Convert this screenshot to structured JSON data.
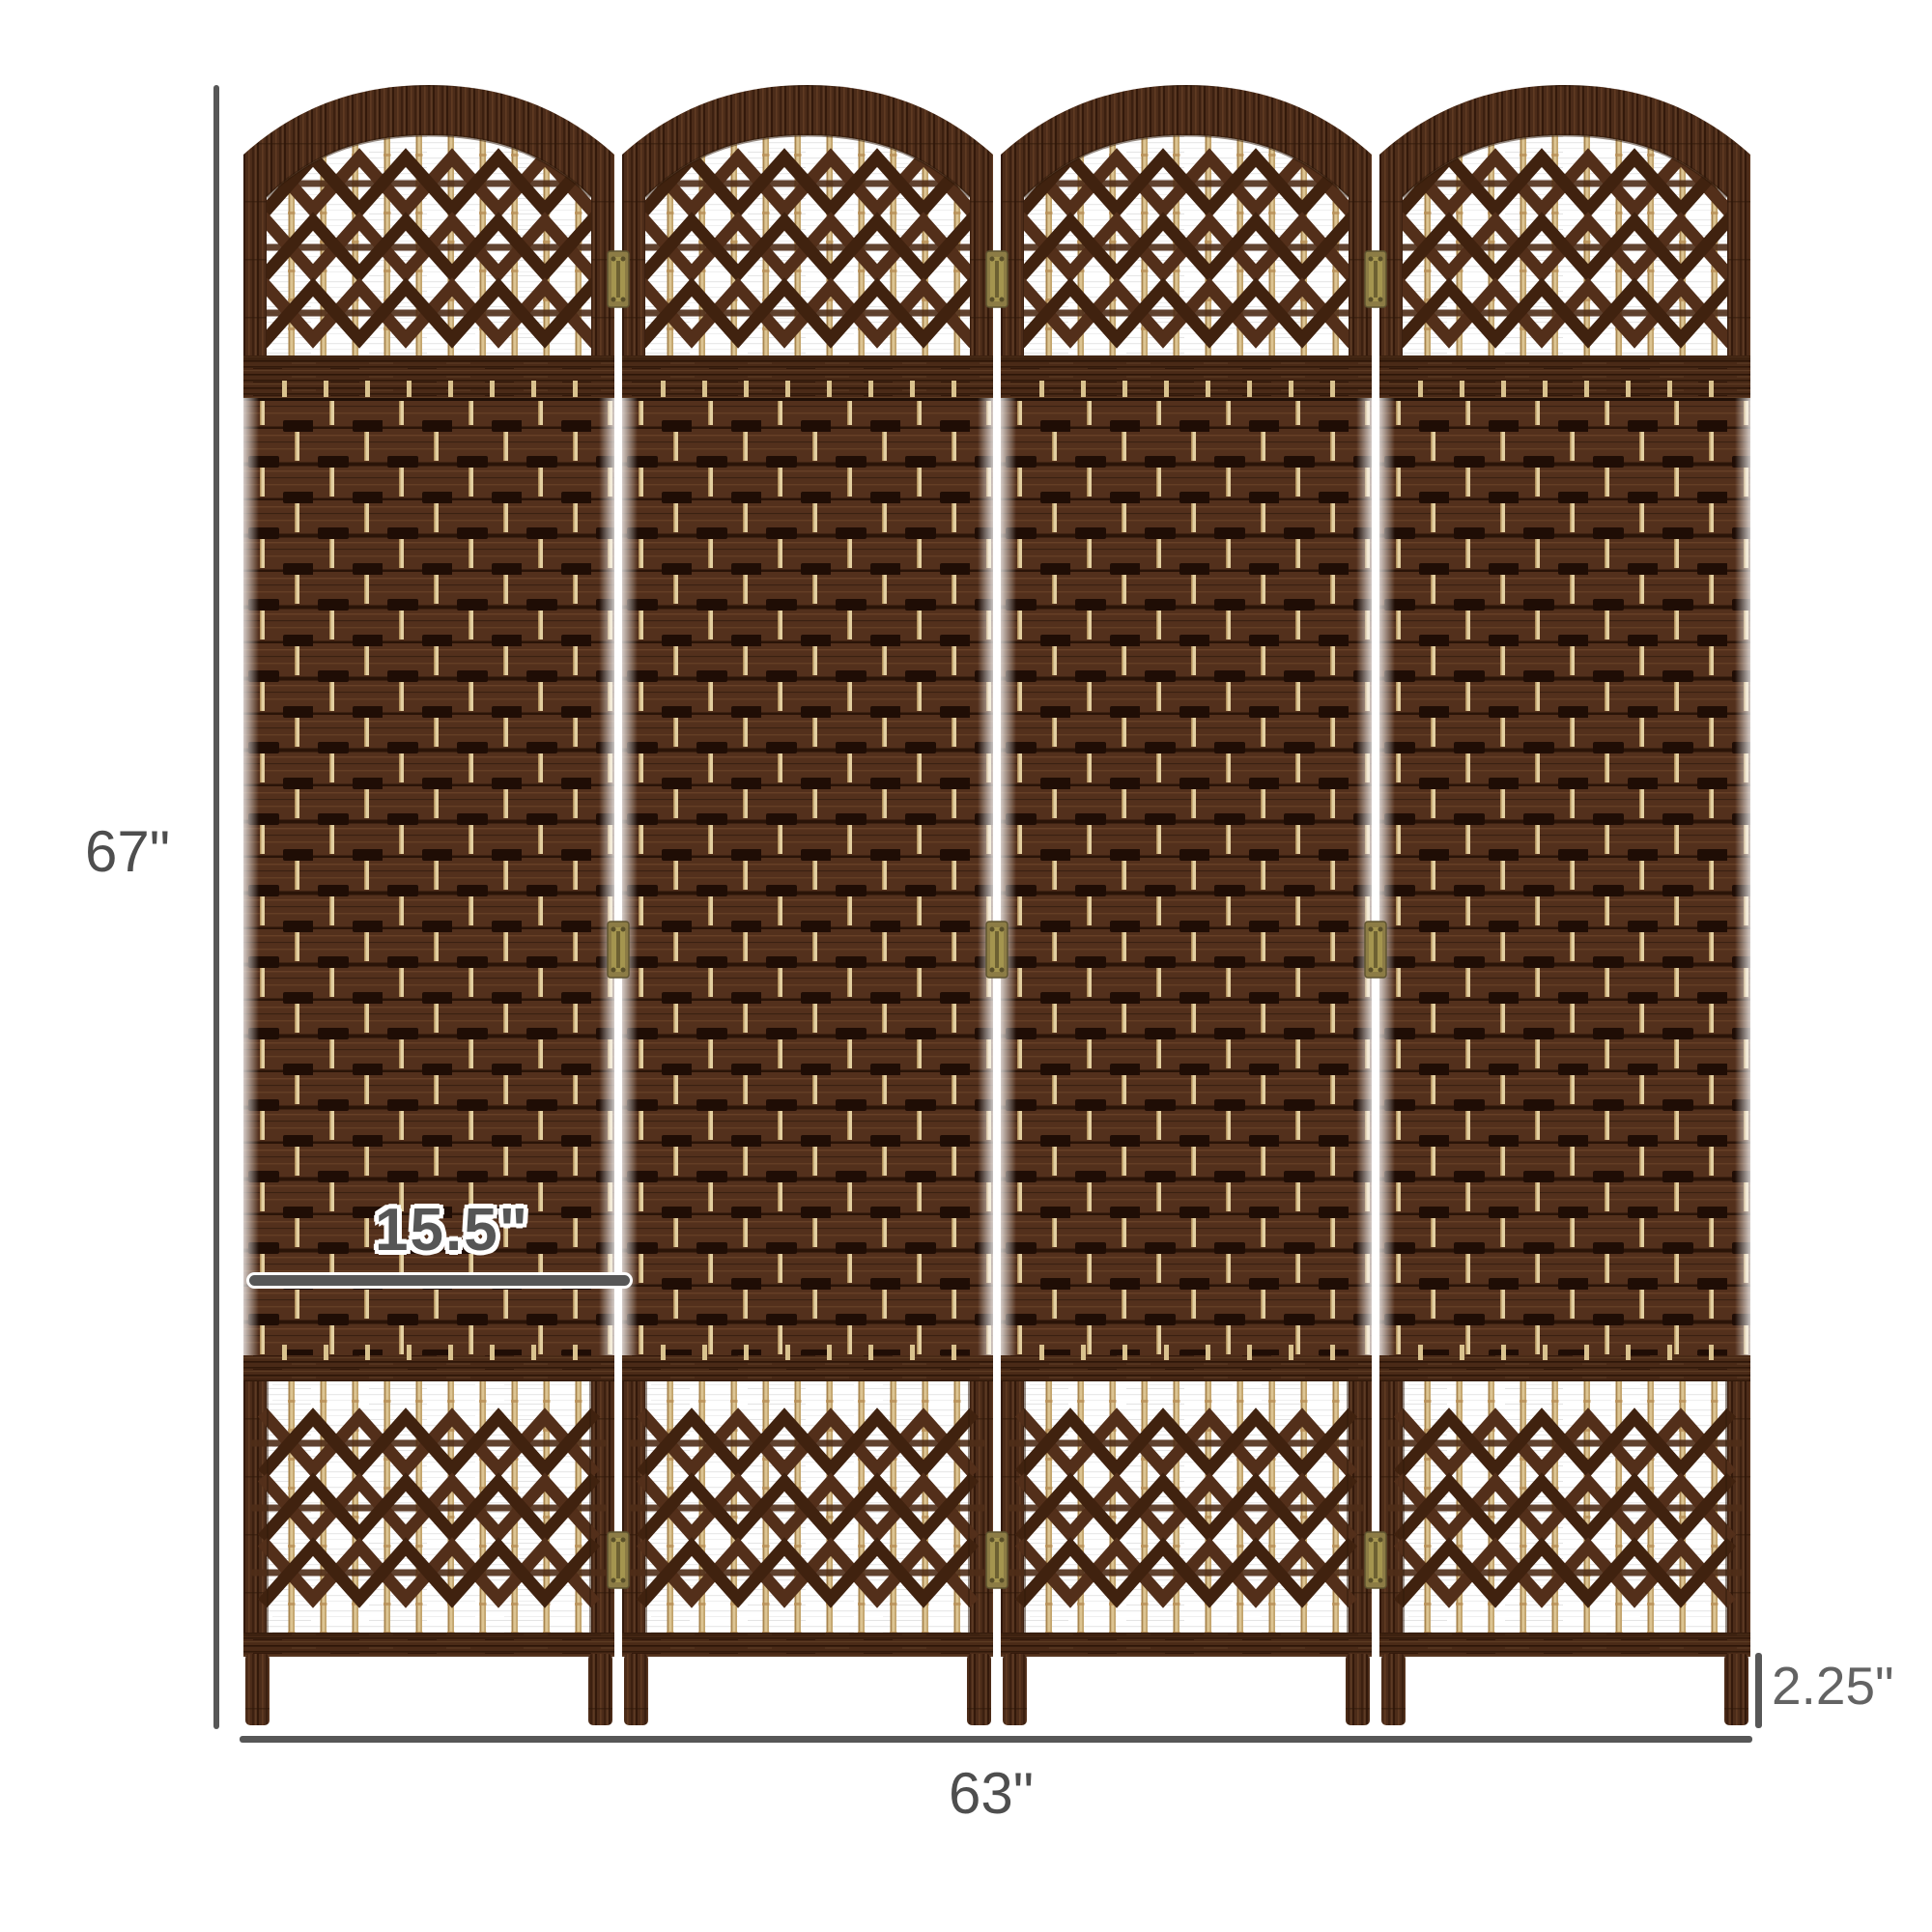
{
  "diagram": {
    "title": "4-panel folding room divider dimension diagram",
    "panels": {
      "count": 4,
      "hinge_count": 9
    },
    "dimensions": {
      "height_label": "67\"",
      "width_label": "63\"",
      "panel_width_label": "15.5\"",
      "thickness_label": "2.25\""
    },
    "colors": {
      "frame_brown": "#4c2c19",
      "weave_brown": "#53301c",
      "weave_slot_shadow": "#1f0d05",
      "bamboo_tan": "#dcc492",
      "cross_weave_brown": "#4e2b17",
      "hinge_brass": "#8c7c45",
      "dimension_gray": "#575757",
      "background": "#ffffff"
    }
  }
}
